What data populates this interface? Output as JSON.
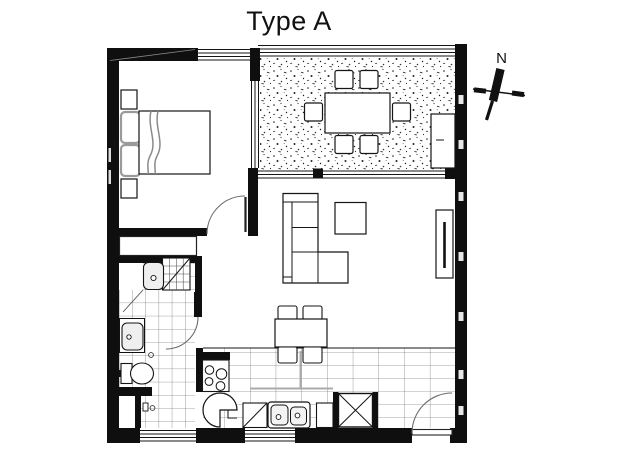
{
  "title": "Type A",
  "compass": {
    "label": "N",
    "icon": "north-arrow-icon"
  },
  "colors": {
    "background": "#ffffff",
    "ink": "#151515",
    "wall": "#0f0f0f",
    "tile_grid": "#4a4a4a",
    "soft_gray": "#9a9a9a",
    "door_arc": "#6b6b6b"
  },
  "symbols": [
    "bed-icon",
    "nightstand-icon",
    "wardrobe-icon",
    "balcony-stipple-floor",
    "outdoor-dining-table-icon",
    "chair-icon",
    "planter-bench-icon",
    "l-sofa-icon",
    "coffee-table-icon",
    "tv-unit-icon",
    "dining-table-icon",
    "cooktop-icon",
    "corner-carousel-icon",
    "dishwasher-icon",
    "double-sink-icon",
    "base-cabinet-icon",
    "fridge-cross-icon",
    "shower-icon",
    "wash-basin-icon",
    "vanity-basin-icon",
    "toilet-icon",
    "floor-drain-icon",
    "door-swing-icon",
    "sliding-door-icon",
    "window-icon",
    "north-arrow-icon"
  ]
}
